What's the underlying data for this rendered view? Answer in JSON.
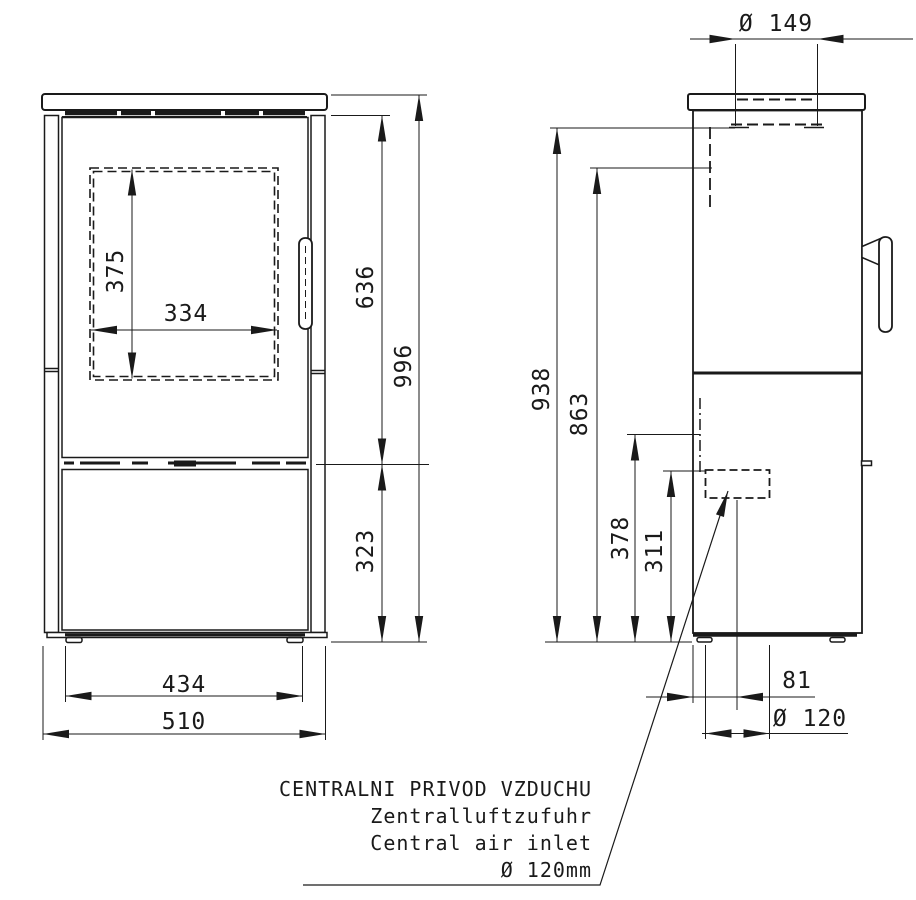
{
  "dimensions": {
    "front": {
      "window_height": "375",
      "window_width": "334",
      "upper_section_height": "636",
      "overall_height": "996",
      "lower_section_height": "323",
      "body_width": "434",
      "overall_width": "510"
    },
    "side": {
      "flue_collar_diameter": "Ø 149",
      "flue_front_height": "938",
      "flue_rear_height": "863",
      "inlet_top_height": "378",
      "inlet_center_height": "311",
      "inlet_offset_depth": "81",
      "inlet_diameter": "Ø 120"
    }
  },
  "note": {
    "lines": [
      "CENTRALNI PRIVOD VZDUCHU",
      "Zentralluftzufuhr",
      "Central air inlet",
      "Ø 120mm"
    ]
  },
  "colors": {
    "line": "#1a1a1a",
    "background": "#ffffff"
  }
}
